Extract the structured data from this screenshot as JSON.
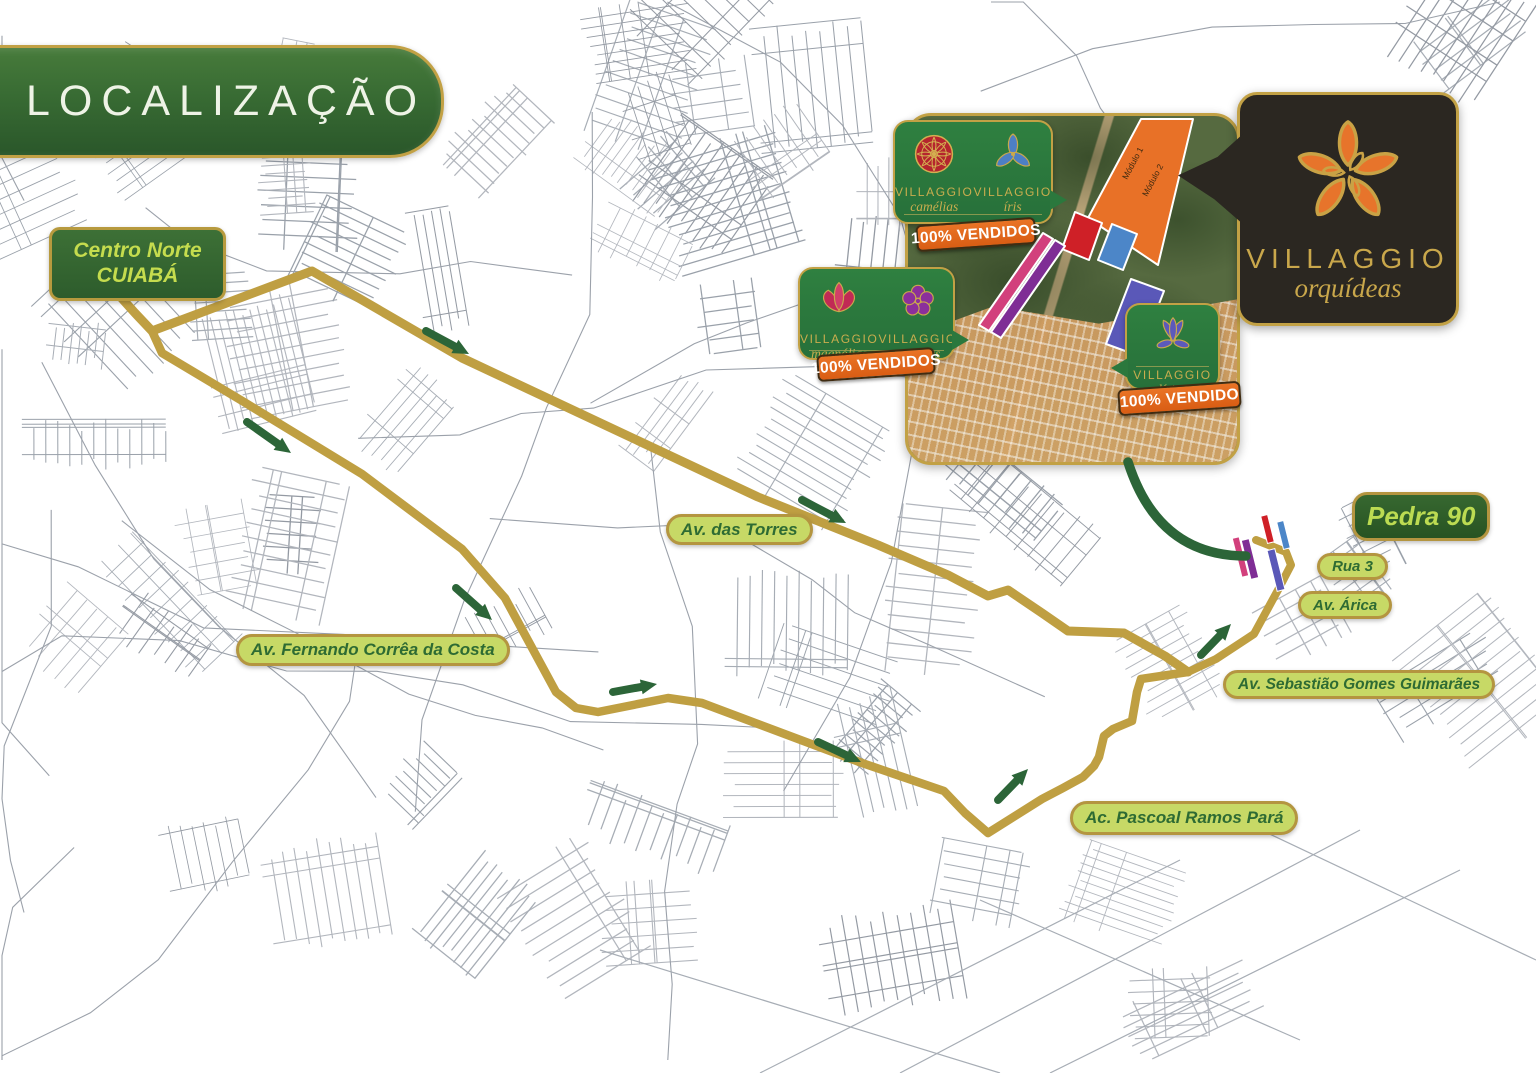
{
  "header": {
    "title": "LOCALIZAÇÃO"
  },
  "origin_badge": {
    "line1": "Centro Norte",
    "line2": "CUIABÁ"
  },
  "logo_badge": {
    "brand": "VILLAGGIO",
    "product": "orquídeas",
    "flower_icon": "orchid-icon",
    "x": 1237,
    "y": 92,
    "w": 222,
    "h": 234
  },
  "road_labels": [
    {
      "id": "av-das-torres",
      "text": "Av. das Torres",
      "style": "light",
      "x": 666,
      "y": 514,
      "w": 127,
      "h": 31,
      "font": 17
    },
    {
      "id": "av-fernando",
      "text": "Av. Fernando Corrêa da Costa",
      "style": "light",
      "x": 236,
      "y": 634,
      "w": 238,
      "h": 32,
      "font": 17
    },
    {
      "id": "ac-pascoal",
      "text": "Ac. Pascoal Ramos Pará",
      "style": "light",
      "x": 1070,
      "y": 801,
      "w": 210,
      "h": 34,
      "font": 17
    },
    {
      "id": "av-sebastiao",
      "text": "Av. Sebastião Gomes Guimarães",
      "style": "light",
      "x": 1223,
      "y": 670,
      "w": 256,
      "h": 29,
      "font": 15.5
    },
    {
      "id": "av-arica",
      "text": "Av. Árica",
      "style": "light",
      "x": 1298,
      "y": 591,
      "w": 80,
      "h": 28,
      "font": 15
    },
    {
      "id": "rua-3",
      "text": "Rua 3",
      "style": "light",
      "x": 1317,
      "y": 553,
      "w": 71,
      "h": 27,
      "font": 15
    },
    {
      "id": "pedra-90",
      "text": "Pedra 90",
      "style": "dark",
      "x": 1352,
      "y": 492,
      "w": 127,
      "h": 49,
      "font": 26
    }
  ],
  "inset": {
    "x": 905,
    "y": 113,
    "w": 335,
    "h": 352,
    "modules": [
      {
        "label": "Módulo 1"
      },
      {
        "label": "Módulo 2"
      }
    ],
    "bubbles": [
      {
        "id": "camelias-iris",
        "x": 893,
        "y": 120,
        "w": 160,
        "h": 104,
        "tail": "right",
        "rule_bottom": 7,
        "brands": [
          {
            "brand": "VILLAGGIO",
            "flower": "camélias",
            "icon": "camelia-icon"
          },
          {
            "brand": "VILLAGGIO",
            "flower": "íris",
            "icon": "iris-icon"
          }
        ],
        "banner": {
          "text": "100% VENDIDOS",
          "x": 916,
          "y": 221,
          "w": 120,
          "h": 27
        }
      },
      {
        "id": "magnolias-violetas",
        "x": 798,
        "y": 267,
        "w": 157,
        "h": 93,
        "tail": "right",
        "rule_bottom": 7,
        "brands": [
          {
            "brand": "VILLAGGIO",
            "flower": "magnólias",
            "icon": "magnolia-icon"
          },
          {
            "brand": "VILLAGGIO",
            "flower": "violettas",
            "icon": "violet-icon"
          }
        ],
        "banner": {
          "text": "100% VENDIDOS",
          "x": 817,
          "y": 351,
          "w": 118,
          "h": 27
        }
      },
      {
        "id": "lirios",
        "x": 1125,
        "y": 303,
        "w": 95,
        "h": 87,
        "tail": "left",
        "rule_bottom": 21,
        "brands": [
          {
            "brand": "VILLAGGIO",
            "flower": "lírios",
            "icon": "lily-icon"
          }
        ],
        "banner": {
          "text": "100% VENDIDO",
          "x": 1118,
          "y": 385,
          "w": 123,
          "h": 27
        }
      }
    ],
    "parcels": [
      {
        "name": "modulo-band",
        "color": "#e87127",
        "points": [
          [
            1138,
            116
          ],
          [
            1190,
            116
          ],
          [
            1155,
            262
          ],
          [
            1085,
            215
          ]
        ]
      },
      {
        "name": "parcel-red",
        "color": "#cf2027",
        "points": [
          [
            1072,
            209
          ],
          [
            1099,
            220
          ],
          [
            1086,
            257
          ],
          [
            1059,
            246
          ]
        ]
      },
      {
        "name": "parcel-blue",
        "color": "#4c86c8",
        "points": [
          [
            1109,
            221
          ],
          [
            1134,
            231
          ],
          [
            1120,
            267
          ],
          [
            1095,
            257
          ]
        ]
      },
      {
        "name": "parcel-indigo",
        "color": "#5a58b8",
        "points": [
          [
            1128,
            276
          ],
          [
            1161,
            288
          ],
          [
            1136,
            353
          ],
          [
            1103,
            341
          ]
        ]
      },
      {
        "name": "strip-pink",
        "color": "#d2407c",
        "points": [
          [
            1040,
            230
          ],
          [
            1050,
            236
          ],
          [
            986,
            328
          ],
          [
            976,
            322
          ]
        ]
      },
      {
        "name": "strip-purple",
        "color": "#7f2d95",
        "points": [
          [
            1052,
            237
          ],
          [
            1062,
            243
          ],
          [
            998,
            335
          ],
          [
            988,
            329
          ]
        ]
      }
    ],
    "module_label_pos": [
      {
        "x": 1124,
        "y": 177,
        "rot": -62
      },
      {
        "x": 1144,
        "y": 194,
        "rot": -62
      }
    ]
  },
  "map": {
    "routes": {
      "upper": [
        [
          117,
          293
        ],
        [
          135,
          313
        ],
        [
          152,
          331
        ],
        [
          312,
          271
        ],
        [
          462,
          358
        ],
        [
          758,
          497
        ],
        [
          878,
          545
        ],
        [
          948,
          575
        ],
        [
          988,
          596
        ],
        [
          1008,
          590
        ],
        [
          1042,
          613
        ],
        [
          1068,
          631
        ],
        [
          1124,
          633
        ],
        [
          1165,
          656
        ],
        [
          1188,
          672
        ]
      ],
      "lower": [
        [
          152,
          331
        ],
        [
          162,
          353
        ],
        [
          244,
          402
        ],
        [
          362,
          474
        ],
        [
          462,
          549
        ],
        [
          505,
          598
        ],
        [
          556,
          692
        ],
        [
          576,
          708
        ],
        [
          598,
          712
        ],
        [
          668,
          698
        ],
        [
          702,
          703
        ],
        [
          862,
          763
        ],
        [
          944,
          791
        ],
        [
          965,
          813
        ],
        [
          988,
          833
        ],
        [
          1042,
          799
        ],
        [
          1063,
          788
        ],
        [
          1083,
          777
        ],
        [
          1094,
          766
        ],
        [
          1099,
          757
        ],
        [
          1104,
          736
        ],
        [
          1113,
          729
        ],
        [
          1132,
          721
        ],
        [
          1137,
          692
        ],
        [
          1141,
          679
        ],
        [
          1188,
          672
        ]
      ],
      "loop": [
        [
          1188,
          672
        ],
        [
          1216,
          659
        ],
        [
          1254,
          634
        ],
        [
          1278,
          590
        ],
        [
          1291,
          565
        ],
        [
          1286,
          552
        ],
        [
          1256,
          540
        ]
      ]
    },
    "arrows": [
      [
        426,
        331,
        469,
        354
      ],
      [
        802,
        500,
        846,
        523
      ],
      [
        247,
        422,
        291,
        453
      ],
      [
        456,
        588,
        492,
        620
      ],
      [
        613,
        692,
        657,
        684
      ],
      [
        818,
        742,
        861,
        762
      ],
      [
        998,
        800,
        1028,
        769
      ],
      [
        1201,
        655,
        1231,
        624
      ]
    ],
    "arc": {
      "from": [
        1128,
        462
      ],
      "ctrl": [
        1158,
        556
      ],
      "to": [
        1246,
        556
      ]
    },
    "dev_strips": [
      {
        "color": "#d2407c",
        "x": 1237,
        "y": 537,
        "w": 7,
        "h": 40,
        "rot": -14
      },
      {
        "color": "#7f2d95",
        "x": 1246,
        "y": 539,
        "w": 8,
        "h": 40,
        "rot": -14
      },
      {
        "color": "#cf2027",
        "x": 1264,
        "y": 515,
        "w": 7,
        "h": 28,
        "rot": -14
      },
      {
        "color": "#4c86c8",
        "x": 1280,
        "y": 521,
        "w": 7,
        "h": 28,
        "rot": -14
      },
      {
        "color": "#5a58b8",
        "x": 1272,
        "y": 549,
        "w": 8,
        "h": 42,
        "rot": -14
      }
    ]
  },
  "colors": {
    "route_gold": "#bf9f42",
    "arrow_green": "#2c6538",
    "street_gray": "#a7adb5",
    "bubble_green": "#2e7d3c",
    "gold_border": "#c2a145",
    "banner_orange": "#e2661b",
    "module_text": "#3f2a10"
  }
}
